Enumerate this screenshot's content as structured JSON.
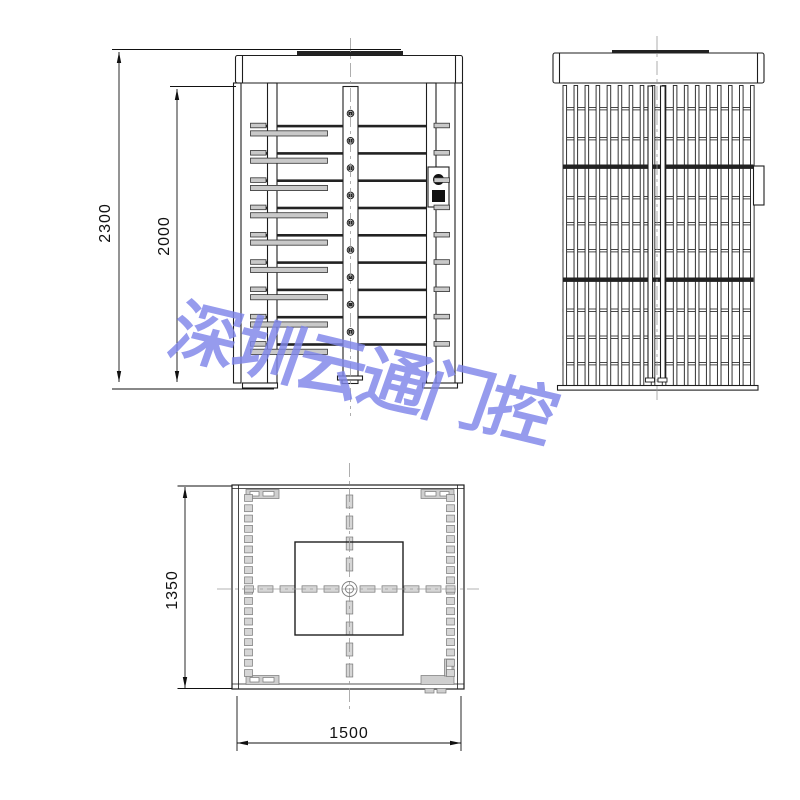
{
  "watermark": {
    "text": "深圳云通门控",
    "color": "#7f86ea"
  },
  "dimensions": {
    "total_height": {
      "label": "2300"
    },
    "housing_height": {
      "label": "2000"
    },
    "plan_depth": {
      "label": "1350"
    },
    "plan_width": {
      "label": "1500"
    }
  },
  "colors": {
    "line": "#1e1e1e",
    "arm_gray": "#c9c9c9",
    "centerline_gray": "#9a9a9a"
  },
  "views": {
    "front": "front-elevation-turnstile",
    "side": "side-elevation-cage",
    "plan": "plan-view-footprint"
  }
}
